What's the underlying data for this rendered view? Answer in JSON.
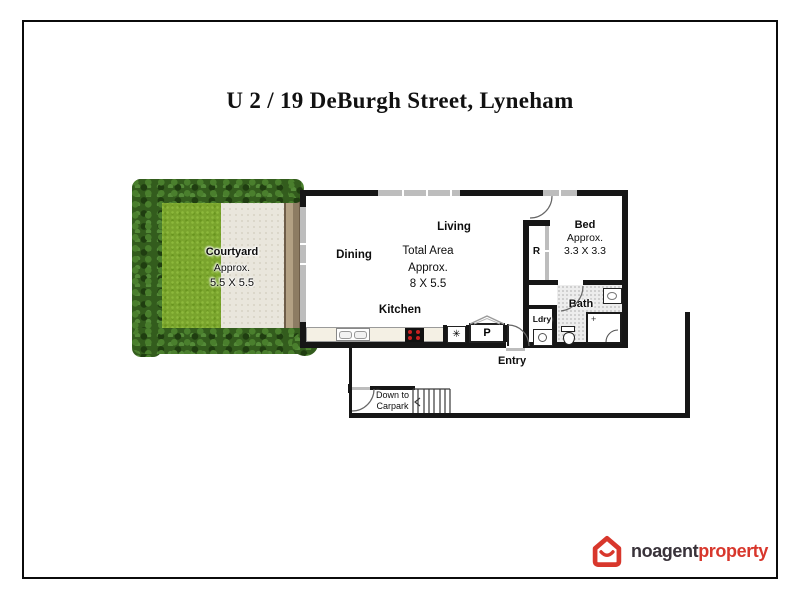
{
  "page": {
    "title": "U 2 / 19 DeBurgh Street, Lyneham"
  },
  "floorplan": {
    "courtyard": {
      "label": "Courtyard",
      "approx": "Approx.",
      "dims": "5.5 X 5.5"
    },
    "dining": {
      "label": "Dining"
    },
    "living": {
      "label": "Living"
    },
    "total_area": {
      "line1": "Total Area",
      "line2": "Approx.",
      "line3": "8 X 5.5"
    },
    "kitchen": {
      "label": "Kitchen"
    },
    "pantry": {
      "label": "P"
    },
    "appliance": {
      "symbol": "✳"
    },
    "bed": {
      "label": "Bed",
      "approx": "Approx.",
      "dims": "3.3 X 3.3"
    },
    "robe": {
      "label": "R"
    },
    "bath": {
      "label": "Bath",
      "shower_mark": "+"
    },
    "laundry": {
      "label": "Ldry"
    },
    "entry": {
      "label": "Entry"
    },
    "stairs": {
      "line1": "Down to",
      "line2": "Carpark"
    }
  },
  "logo": {
    "brand_primary": "noagent",
    "brand_accent": "property"
  },
  "colors": {
    "frame": "#0b0b0b",
    "wall": "#161616",
    "window": "#bdbdbd",
    "hedge": "#335c1d",
    "hedge_light": "#4a7f2d",
    "hedge_dark": "#1f3d10",
    "grass": "#7aa42d",
    "patio": "#e9e6dc",
    "deck_light": "#b3a184",
    "deck_dark": "#8d7c63",
    "counter": "#f4f0e4",
    "burner": "#c92020",
    "tile": "#ededed",
    "logo_red": "#d8372c",
    "logo_dark": "#39333a"
  }
}
